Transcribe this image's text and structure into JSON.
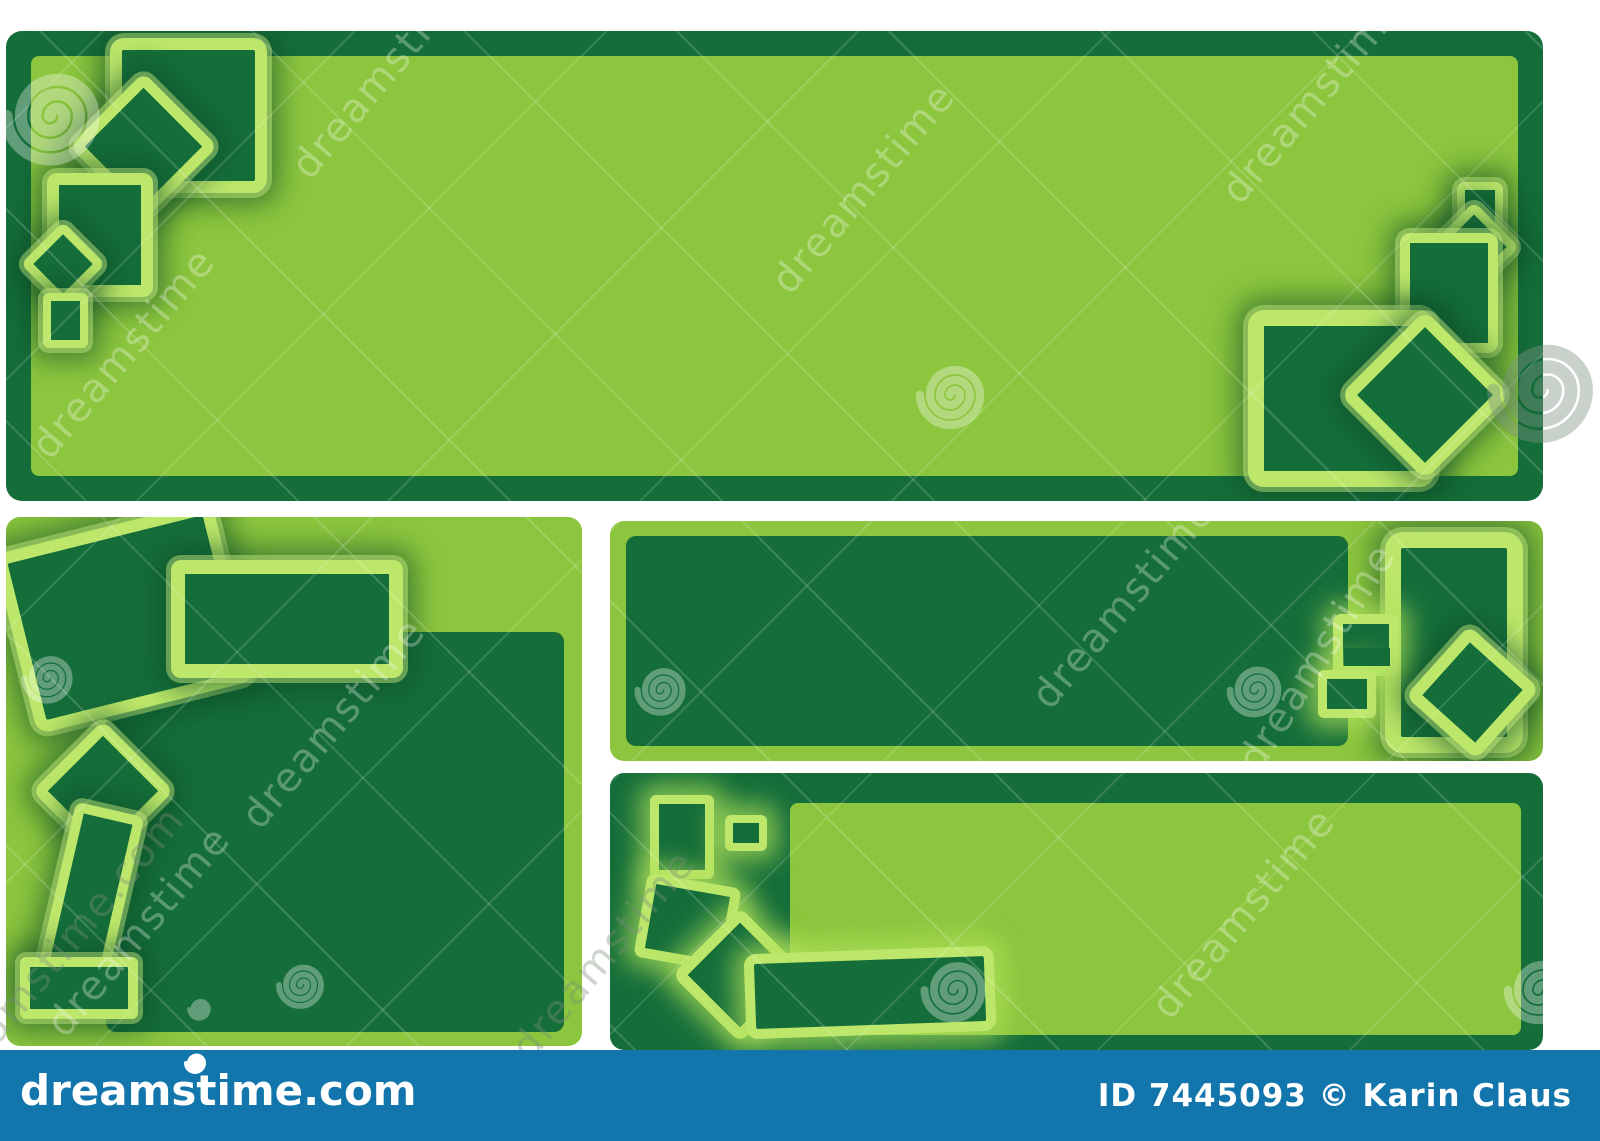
{
  "colors": {
    "page_bg": "#ffffff",
    "light_green": "#8cc63e",
    "dark_green": "#156e3a",
    "glow_green": "#aadd55",
    "footer_blue": "#1276ad"
  },
  "watermark": {
    "text": "dreamstime",
    "partial_text": "eamstime.com"
  },
  "icons": {
    "spiral": "spiral-watermark-icon"
  },
  "footer": {
    "logo_text": "dreamstime.com",
    "credit_text": "ID 7445093 © Karin Claus"
  }
}
